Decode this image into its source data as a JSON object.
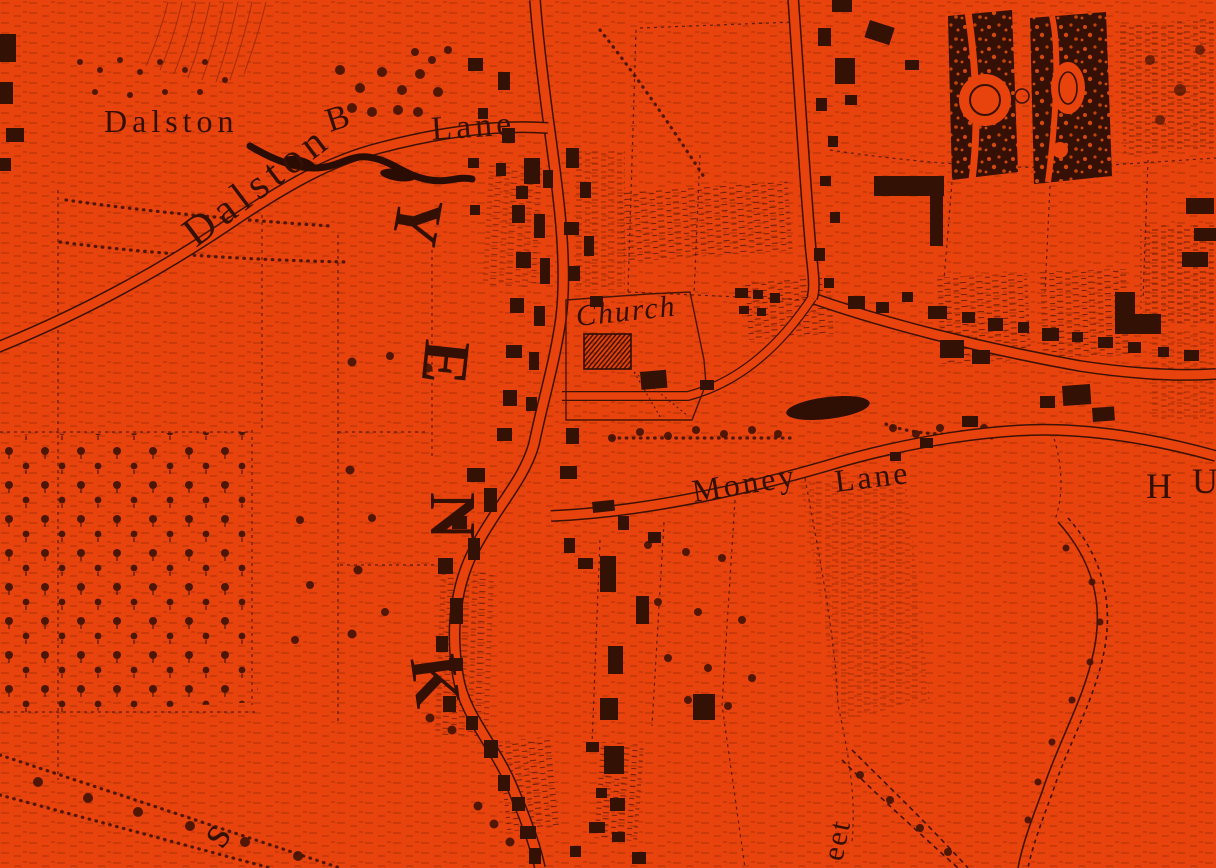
{
  "map": {
    "kind": "historic-engraved-map",
    "area_hint": "Dalston / Hackney village with church, fields and lanes",
    "palette": {
      "background": "#E8420D",
      "ink_dark": "#2F0E03",
      "ink_mid": "#7B2406",
      "building": "#331104"
    },
    "labels": {
      "settlement": "Dalston",
      "lane_diagonal": "Dalston",
      "lane_initial": "B",
      "lane_word": "Lane",
      "church": "Church",
      "money": "Money",
      "money_lane_word": "Lane",
      "hackney_y": "Y",
      "hackney_e": "E",
      "hackney_n": "N",
      "hackney_k": "K",
      "humerton_h": "H",
      "humerton_u": "U",
      "street_fragment": "eet",
      "fields_fragment": "s"
    }
  }
}
